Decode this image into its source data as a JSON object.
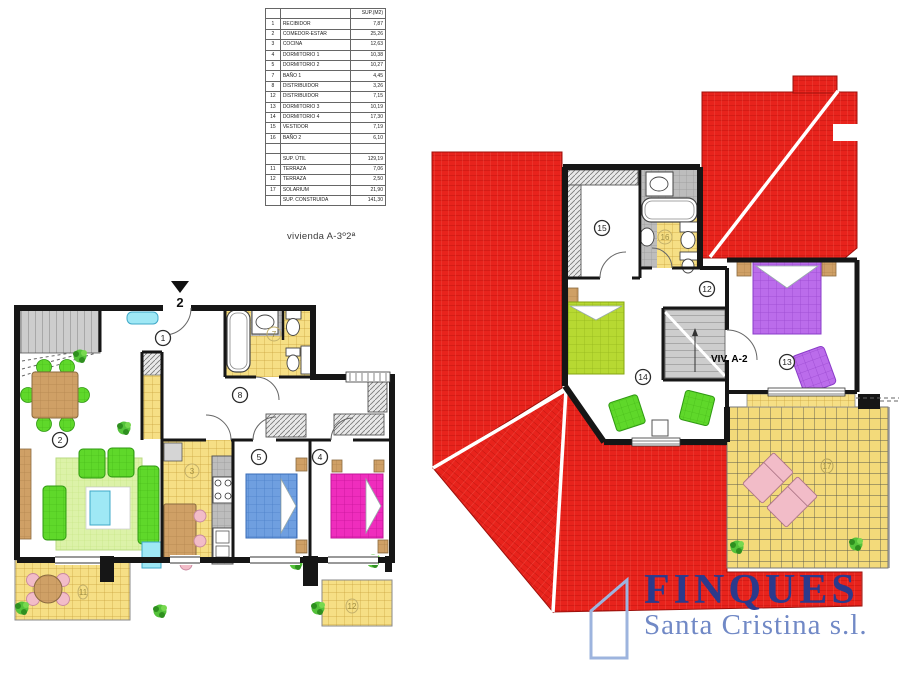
{
  "meta": {
    "plan_label": "vivienda A-3º2ª",
    "entrance_number": "2",
    "viv_label": "VIV. A-2"
  },
  "area_table": {
    "header": "SUP.(M2)",
    "rows": [
      {
        "num": "1",
        "name": "RECIBIDOR",
        "area": "7,87"
      },
      {
        "num": "2",
        "name": "COMEDOR-ESTAR",
        "area": "25,26"
      },
      {
        "num": "3",
        "name": "COCINA",
        "area": "12,63"
      },
      {
        "num": "4",
        "name": "DORMITORIO 1",
        "area": "10,38"
      },
      {
        "num": "5",
        "name": "DORMITORIO 2",
        "area": "10,27"
      },
      {
        "num": "7",
        "name": "BAÑO 1",
        "area": "4,45"
      },
      {
        "num": "8",
        "name": "DISTRIBUIDOR",
        "area": "3,26"
      },
      {
        "num": "12",
        "name": "DISTRIBUIDOR",
        "area": "7,15"
      },
      {
        "num": "13",
        "name": "DORMITORIO 3",
        "area": "10,19"
      },
      {
        "num": "14",
        "name": "DORMITORIO 4",
        "area": "17,30"
      },
      {
        "num": "15",
        "name": "VESTIDOR",
        "area": "7,19"
      },
      {
        "num": "16",
        "name": "BAÑO 2",
        "area": "6,10"
      },
      {
        "num": "",
        "name": "",
        "area": ""
      }
    ],
    "summary": [
      {
        "num": "",
        "name": "SUP. ÚTIL",
        "area": "129,19"
      },
      {
        "num": "11",
        "name": "TERRAZA",
        "area": "7,06"
      },
      {
        "num": "12",
        "name": "TERRAZA",
        "area": "2,50"
      },
      {
        "num": "17",
        "name": "SOLARIUM",
        "area": "21,90"
      },
      {
        "num": "",
        "name": "SUP. CONSTRUIDA",
        "area": "141,30"
      }
    ]
  },
  "lower_plan": {
    "labels": {
      "recibidor": "1",
      "salon": "2",
      "cocina": "3",
      "dorm1": "4",
      "dorm2": "5",
      "bano1": "7",
      "distribuidor": "8",
      "terraza_a": "11",
      "terraza_b": "12"
    }
  },
  "upper_plan": {
    "labels": {
      "distribuidor": "12",
      "dorm3": "13",
      "dorm4": "14",
      "vestidor": "15",
      "bano2": "16",
      "solarium": "17"
    }
  },
  "logo": {
    "line1": "FINQUES",
    "line2": "Santa Cristina s.l."
  },
  "colors": {
    "roof-red": "#e8231c",
    "tile-yellow": "#f6df85",
    "logo-navy": "#2b3a8c",
    "logo-blue": "#7189c6",
    "wall-black": "#161616",
    "bed-blue": "#6f9fe0",
    "bed-magenta": "#ef2dbd",
    "bed-purple": "#bb6ceb",
    "bed-lime": "#b7d932",
    "sofa-green": "#5fd82a",
    "accent-pink": "#f2bcc8",
    "accent-cyan": "#9fe8f5"
  }
}
